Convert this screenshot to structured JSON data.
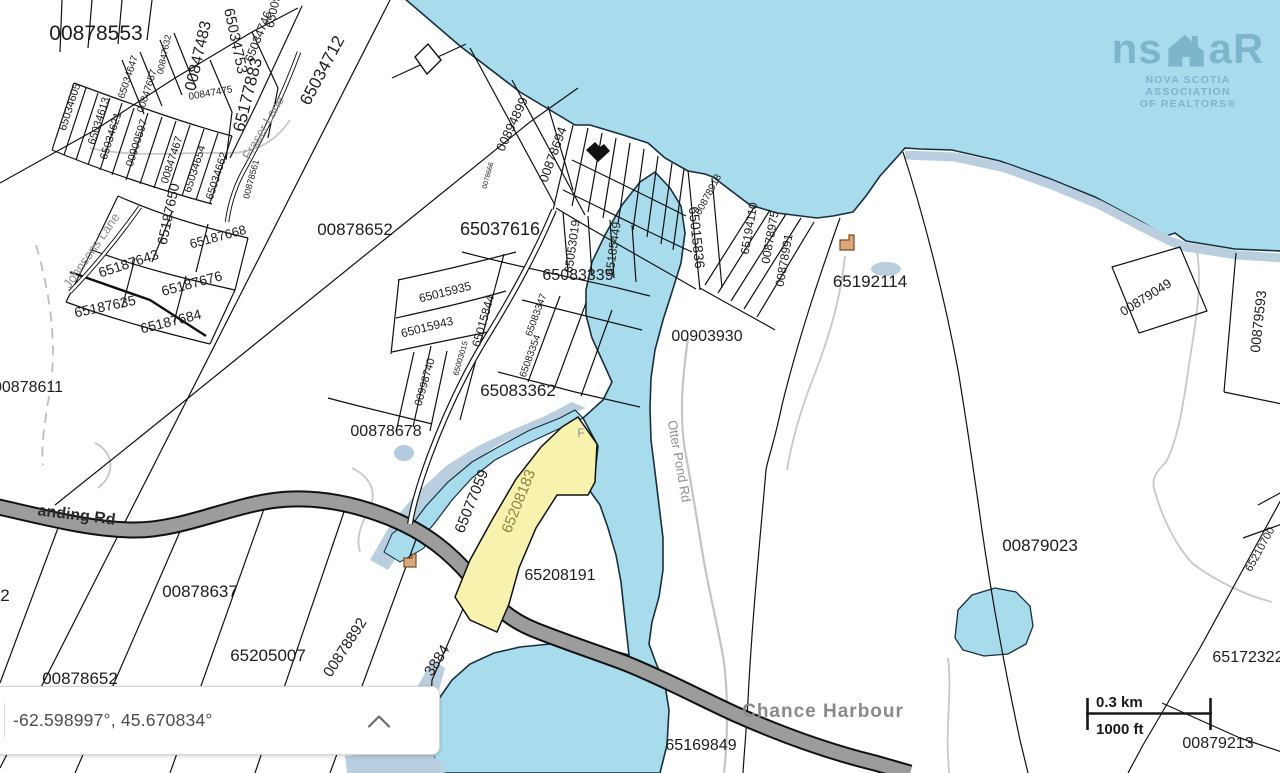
{
  "coordinate_panel": {
    "coordinates": "-62.598997°, 45.670834°",
    "collapse_icon": "chevron-up"
  },
  "scale_bar": {
    "km": "0.3 km",
    "ft": "1000 ft"
  },
  "logo": {
    "prefix": "ns",
    "suffix": "aR",
    "line1": "NOVA SCOTIA ASSOCIATION",
    "line2": "OF REALTORS®"
  },
  "colors": {
    "water": "#a8dcec",
    "water_shallow": "#b9cfe0",
    "land": "#ffffff",
    "road_fill": "#9c9c9c",
    "road_casing": "#111111",
    "boundary": "#111111",
    "selected_parcel_fill": "#f7f3ae",
    "selected_label": "#8a8147",
    "parcel_label": "#1d1d1d",
    "muted_label": "#8d8d8d",
    "logo_blue": "#7cb5cc"
  },
  "map": {
    "selected_parcel": {
      "pid": "65208183"
    },
    "place_name": "Chance Harbour",
    "labels": [
      {
        "text": "00878553",
        "x": 96,
        "y": 40,
        "r": 0,
        "s": 21
      },
      {
        "text": "65034712",
        "x": 327,
        "y": 73,
        "r": -62,
        "s": 17
      },
      {
        "text": "00847483",
        "x": 203,
        "y": 57,
        "r": -77,
        "s": 16
      },
      {
        "text": "65034753",
        "x": 231,
        "y": 42,
        "r": 78,
        "s": 15
      },
      {
        "text": "65034746",
        "x": 262,
        "y": 38,
        "r": -68,
        "s": 12
      },
      {
        "text": "65009",
        "x": 277,
        "y": 12,
        "r": -78,
        "s": 12
      },
      {
        "text": "65177883",
        "x": 253,
        "y": 96,
        "r": -76,
        "s": 17
      },
      {
        "text": "00847475",
        "x": 211,
        "y": 96,
        "r": -10,
        "s": 10
      },
      {
        "text": "00847632",
        "x": 167,
        "y": 55,
        "r": -78,
        "s": 9
      },
      {
        "text": "00847657",
        "x": 150,
        "y": 92,
        "r": -72,
        "s": 10
      },
      {
        "text": "65034647",
        "x": 131,
        "y": 78,
        "r": -72,
        "s": 10
      },
      {
        "text": "65034605",
        "x": 73,
        "y": 108,
        "r": -72,
        "s": 11
      },
      {
        "text": "65034613",
        "x": 102,
        "y": 122,
        "r": -72,
        "s": 11
      },
      {
        "text": "65034621",
        "x": 114,
        "y": 137,
        "r": -72,
        "s": 11
      },
      {
        "text": "00900597",
        "x": 140,
        "y": 144,
        "r": -72,
        "s": 11
      },
      {
        "text": "00847467",
        "x": 175,
        "y": 161,
        "r": -72,
        "s": 11
      },
      {
        "text": "65034654",
        "x": 198,
        "y": 170,
        "r": -72,
        "s": 11
      },
      {
        "text": "65034662",
        "x": 220,
        "y": 177,
        "r": -72,
        "s": 11
      },
      {
        "text": "00878561",
        "x": 254,
        "y": 180,
        "r": -75,
        "s": 9
      },
      {
        "text": "65187650",
        "x": 173,
        "y": 215,
        "r": -78,
        "s": 14
      },
      {
        "text": "65187668",
        "x": 219,
        "y": 241,
        "r": -15,
        "s": 13
      },
      {
        "text": "65187643",
        "x": 130,
        "y": 268,
        "r": -18,
        "s": 14
      },
      {
        "text": "65187676",
        "x": 193,
        "y": 288,
        "r": -15,
        "s": 14
      },
      {
        "text": "65187635",
        "x": 106,
        "y": 311,
        "r": -12,
        "s": 14
      },
      {
        "text": "65187684",
        "x": 172,
        "y": 326,
        "r": -14,
        "s": 14
      },
      {
        "text": "00878611",
        "x": 28,
        "y": 392,
        "r": 0,
        "s": 16
      },
      {
        "text": "00878652",
        "x": 355,
        "y": 235,
        "r": 0,
        "s": 17
      },
      {
        "text": "65037616",
        "x": 500,
        "y": 235,
        "r": 0,
        "s": 18
      },
      {
        "text": "00894899",
        "x": 516,
        "y": 126,
        "r": -65,
        "s": 13
      },
      {
        "text": "00878694",
        "x": 557,
        "y": 156,
        "r": -70,
        "s": 13
      },
      {
        "text": "0078666",
        "x": 490,
        "y": 176,
        "r": -75,
        "s": 7
      },
      {
        "text": "65053019",
        "x": 576,
        "y": 247,
        "r": -82,
        "s": 12
      },
      {
        "text": "65185449",
        "x": 617,
        "y": 249,
        "r": -82,
        "s": 12
      },
      {
        "text": "65083339",
        "x": 578,
        "y": 280,
        "r": 0,
        "s": 16
      },
      {
        "text": "65015836",
        "x": 692,
        "y": 238,
        "r": 84,
        "s": 14
      },
      {
        "text": "00878918",
        "x": 711,
        "y": 196,
        "r": -62,
        "s": 10
      },
      {
        "text": "65194110",
        "x": 753,
        "y": 229,
        "r": -80,
        "s": 12
      },
      {
        "text": "00878975",
        "x": 774,
        "y": 238,
        "r": -80,
        "s": 12
      },
      {
        "text": "00878991",
        "x": 788,
        "y": 261,
        "r": -80,
        "s": 12
      },
      {
        "text": "65192114",
        "x": 870,
        "y": 287,
        "r": 0,
        "s": 17
      },
      {
        "text": "00903930",
        "x": 707,
        "y": 341,
        "r": 0,
        "s": 16
      },
      {
        "text": "00879049",
        "x": 1148,
        "y": 301,
        "r": -32,
        "s": 13
      },
      {
        "text": "00879593",
        "x": 1263,
        "y": 322,
        "r": -84,
        "s": 14
      },
      {
        "text": "65015935",
        "x": 446,
        "y": 296,
        "r": -14,
        "s": 12
      },
      {
        "text": "65015943",
        "x": 428,
        "y": 331,
        "r": -14,
        "s": 12
      },
      {
        "text": "65015844",
        "x": 487,
        "y": 322,
        "r": -74,
        "s": 12
      },
      {
        "text": "00998740",
        "x": 428,
        "y": 383,
        "r": -74,
        "s": 11
      },
      {
        "text": "65003015",
        "x": 463,
        "y": 359,
        "r": -74,
        "s": 8
      },
      {
        "text": "65083347",
        "x": 539,
        "y": 316,
        "r": -70,
        "s": 10
      },
      {
        "text": "65083354",
        "x": 533,
        "y": 357,
        "r": -70,
        "s": 10
      },
      {
        "text": "65083362",
        "x": 518,
        "y": 396,
        "r": 0,
        "s": 17
      },
      {
        "text": "00878678",
        "x": 386,
        "y": 436,
        "r": 0,
        "s": 16
      },
      {
        "text": "65077059",
        "x": 476,
        "y": 503,
        "r": -68,
        "s": 15
      },
      {
        "text": "65208183",
        "x": 523,
        "y": 503,
        "r": -68,
        "s": 15,
        "type": "selected"
      },
      {
        "text": "65208191",
        "x": 560,
        "y": 580,
        "r": 0,
        "s": 16
      },
      {
        "text": "00878637",
        "x": 200,
        "y": 597,
        "r": 0,
        "s": 17
      },
      {
        "text": "65205007",
        "x": 268,
        "y": 661,
        "r": 0,
        "s": 17
      },
      {
        "text": "00878652",
        "x": 80,
        "y": 684,
        "r": 0,
        "s": 17
      },
      {
        "text": "2",
        "x": 5,
        "y": 601,
        "r": 0,
        "s": 17
      },
      {
        "text": "00878892",
        "x": 349,
        "y": 650,
        "r": -57,
        "s": 15
      },
      {
        "text": "3884",
        "x": 441,
        "y": 663,
        "r": -57,
        "s": 15
      },
      {
        "text": "65169849",
        "x": 701,
        "y": 750,
        "r": 0,
        "s": 16
      },
      {
        "text": "00879023",
        "x": 1040,
        "y": 551,
        "r": 0,
        "s": 17
      },
      {
        "text": "65210700",
        "x": 1263,
        "y": 551,
        "r": -61,
        "s": 11
      },
      {
        "text": "65172322",
        "x": 1248,
        "y": 662,
        "r": 0,
        "s": 16
      },
      {
        "text": "00879213",
        "x": 1218,
        "y": 748,
        "r": 0,
        "s": 16
      },
      {
        "text": "anding Rd",
        "x": 76,
        "y": 520,
        "r": 7,
        "s": 16,
        "type": "roadname"
      },
      {
        "text": "Johnsons Lane",
        "x": 95,
        "y": 253,
        "r": -55,
        "s": 13,
        "type": "lane"
      },
      {
        "text": "Fraser Lane",
        "x": 267,
        "y": 130,
        "r": -60,
        "s": 13,
        "type": "lane"
      },
      {
        "text": "Otter Pond Rd",
        "x": 675,
        "y": 462,
        "r": 80,
        "s": 13,
        "type": "lane"
      },
      {
        "text": "F",
        "x": 581,
        "y": 437,
        "r": 0,
        "s": 12,
        "type": "lane"
      },
      {
        "text": "Chance Harbour",
        "x": 823,
        "y": 717,
        "r": 0,
        "s": 19,
        "type": "place"
      }
    ]
  }
}
